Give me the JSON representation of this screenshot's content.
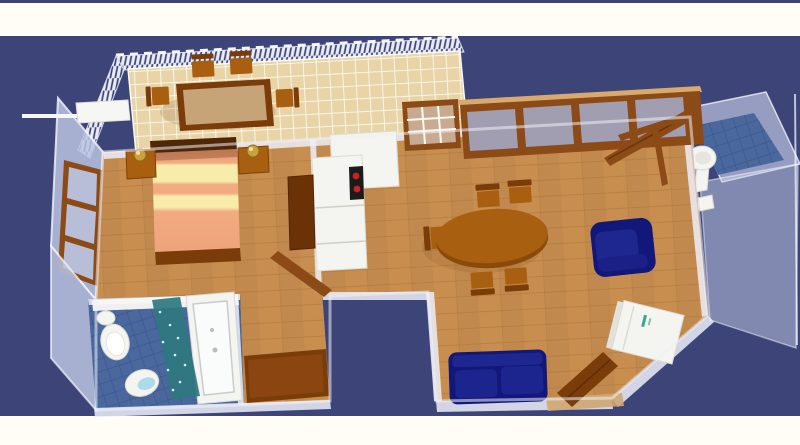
{
  "scene": {
    "type": "3d-floor-plan-render",
    "description": "Aerial 3D rendering of a one-bedroom apartment: tiled balcony with dining set, bedroom with striped double bed, kitchen with cooktop, living-dining room with oval table, navy sofa and armchair, two bathrooms with white fixtures, translucent walls on a dark navy backdrop",
    "rooms": [
      {
        "name": "balcony",
        "floor": "tan-tile"
      },
      {
        "name": "bedroom",
        "floor": "wood"
      },
      {
        "name": "kitchen",
        "floor": "wood"
      },
      {
        "name": "living-dining-room",
        "floor": "wood"
      },
      {
        "name": "main-bathroom",
        "floor": "blue-tile"
      },
      {
        "name": "toilet-room",
        "floor": "blue-tile"
      },
      {
        "name": "storage-room",
        "floor": "wood"
      }
    ],
    "furniture": {
      "balcony": [
        "rectangular-table",
        "four-wooden-chairs",
        "hatched-railing"
      ],
      "bedroom": [
        "double-bed-striped",
        "nightstand-left",
        "nightstand-right",
        "two-gold-lamps",
        "wardrobe",
        "open-door",
        "glazed-window-wall",
        "white-shelf"
      ],
      "kitchen": [
        "white-tall-unit",
        "white-counter",
        "black-cooktop-red-burners",
        "grid-window"
      ],
      "living-dining-room": [
        "oval-dining-table",
        "five-wooden-chairs",
        "navy-armchair",
        "navy-sofa",
        "television",
        "white-appliance",
        "open-entry-door",
        "door-mat",
        "large-glazed-window",
        "open-window-leaf"
      ],
      "main-bathroom": [
        "toilet",
        "bidet",
        "teal-shower",
        "bathtub",
        "white-shelf"
      ],
      "toilet-room": [
        "pedestal-sink",
        "toilet"
      ],
      "storage-room": [
        "dark-brown-desk"
      ]
    },
    "colors": {
      "bg-navy": "#3d4478",
      "page-white": "#fffdf6",
      "wood": "#c88e50",
      "wood-line": "#ab763c",
      "tile-tan": "#e8d4a6",
      "tile-grout": "#fafaf2",
      "tile-blue": "#4a689e",
      "tile-blue-line": "#3b5486",
      "wall-glass": "rgba(205,212,238,0.62)",
      "wall-face": "rgba(186,195,224,0.85)",
      "wall-band": "rgba(236,239,248,0.85)",
      "wall-edge": "#f2f4fa",
      "frame-brown": "#8b4a16",
      "furn-brown": "#a85f10",
      "furn-brown-dark": "#7a3c08",
      "table-top": "#c7a478",
      "wardrobe-brown": "#6b3208",
      "bed-frame": "#4f2606",
      "bed-salmon": "#f2aa80",
      "bed-cream": "#f8ecaa",
      "sofa-navy": "#12187a",
      "sofa-navy-light": "#1e2690",
      "fixture-white": "#f4f4f0",
      "fixture-line": "#d8d8d0",
      "shower-teal": "#2f7880",
      "water-blue": "#aadcec",
      "cooktop-black": "#1b1b1b",
      "burner-red": "#cf2020",
      "lamp-gold": "#caa23c",
      "tv-black": "#0c0c0c",
      "tv-base": "#646850",
      "appliance-white": "#f4f4f0",
      "rail-navy": "#3d4478",
      "rail-bg": "#e8ebf4",
      "shadow": "rgba(96,52,10,0.28)",
      "threshold-tan": "#cfa670"
    }
  }
}
